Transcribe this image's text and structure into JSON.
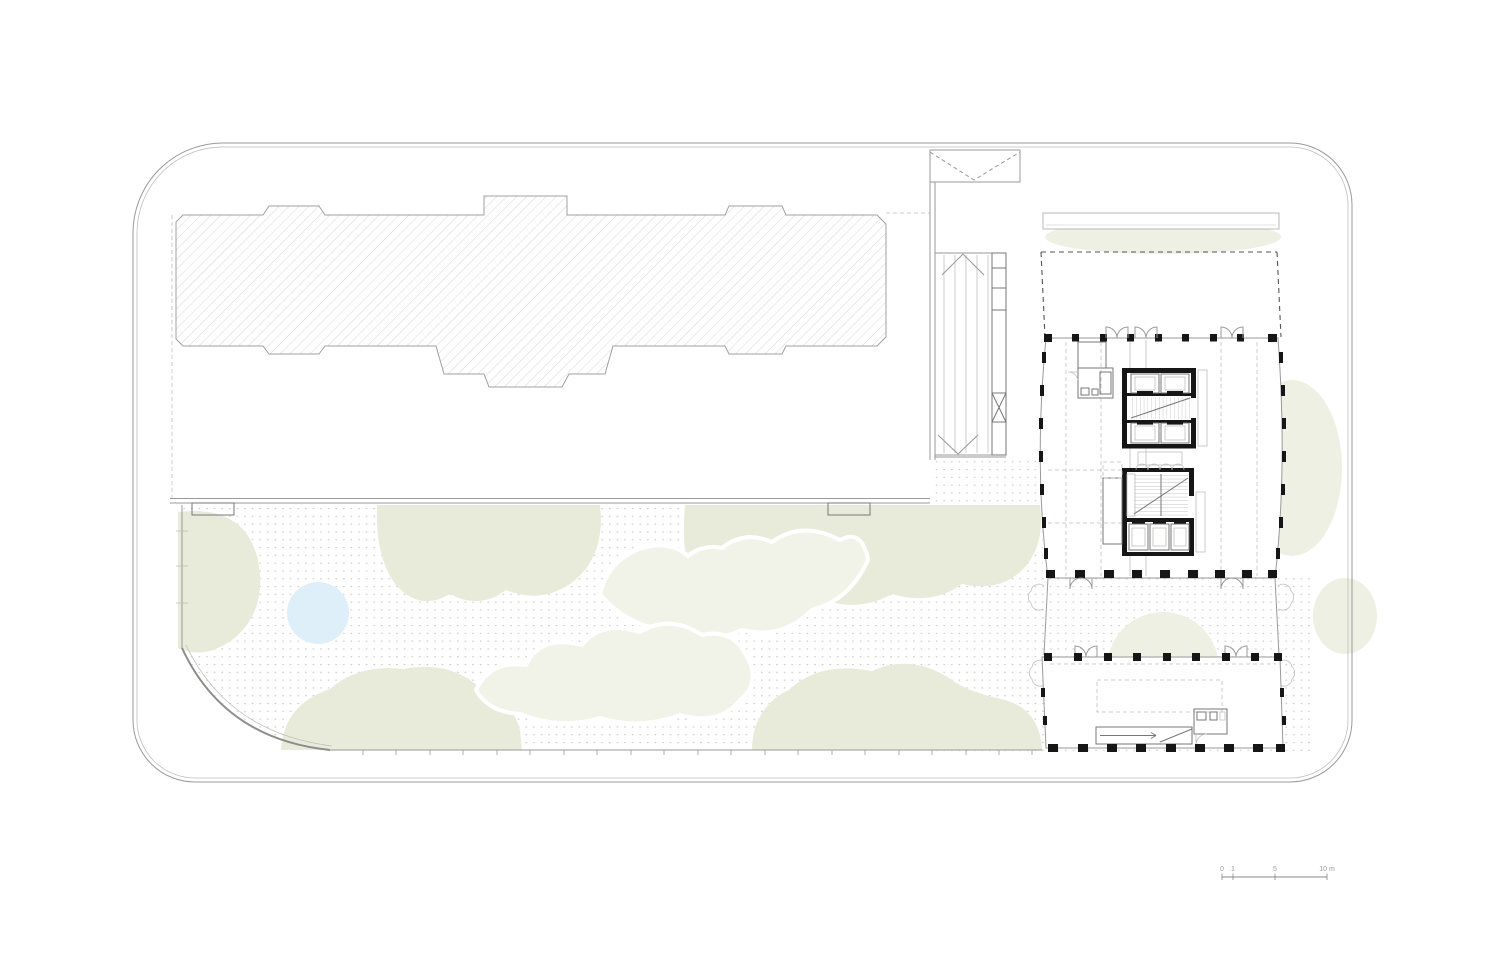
{
  "drawing": {
    "kind": "architectural ground-floor site plan",
    "visible_text_note": "only text rendered on the drawing is the scale bar labels"
  },
  "scale_bar": {
    "labels": [
      "0",
      "1",
      "5",
      "10 m"
    ],
    "unit": "m"
  },
  "colors": {
    "background": "#ffffff",
    "planting_dark": "#e8ebda",
    "planting_light": "#f1f3e8",
    "water": "#deeffa",
    "paving_dot": "#c8c8c4",
    "hatch_line": "#d6d6d4",
    "linework_light": "#b5b5b3",
    "linework_medium": "#9a9a9a",
    "structure_black": "#161616"
  }
}
